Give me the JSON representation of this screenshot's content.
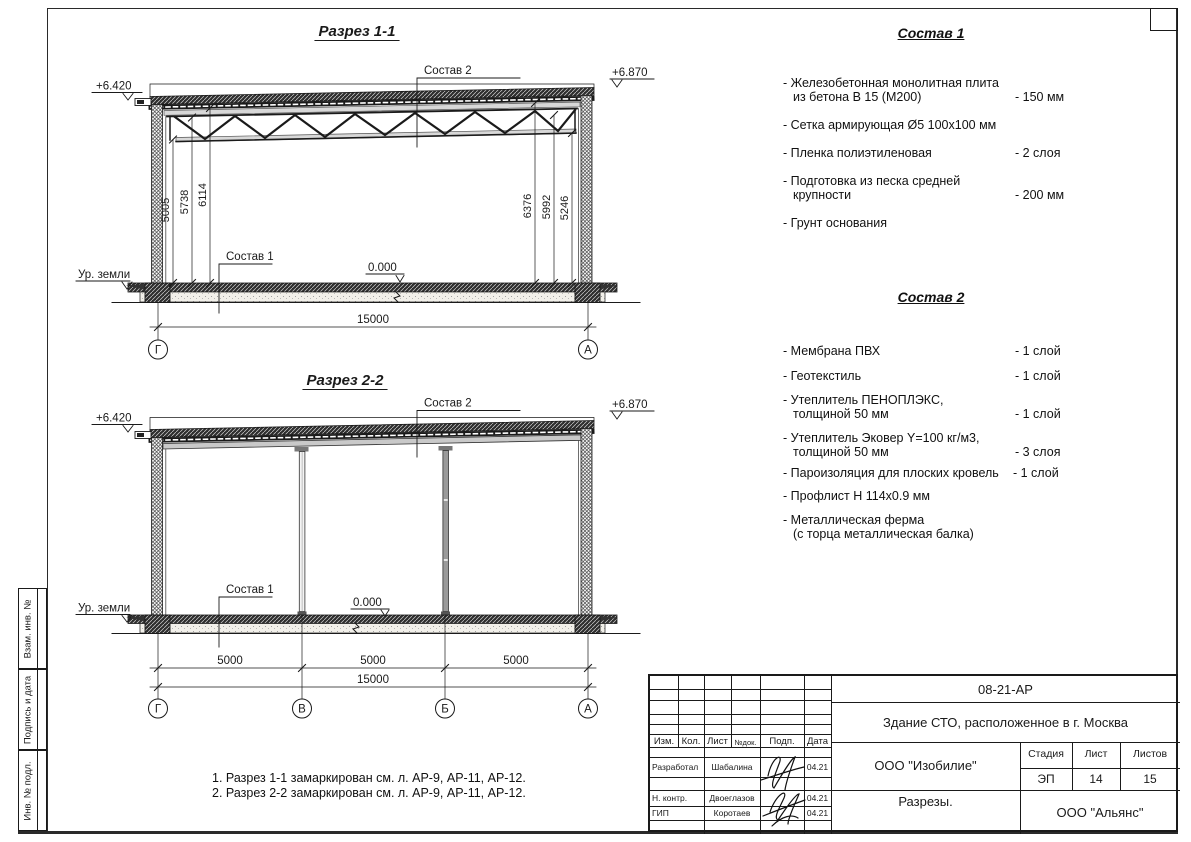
{
  "colors": {
    "ink": "#1a1a1a",
    "paper": "#ffffff"
  },
  "side_strip": {
    "cells": [
      {
        "label": "Взам. инв. №"
      },
      {
        "label": "Подпись и дата"
      },
      {
        "label": "Инв. № подл."
      }
    ]
  },
  "section1": {
    "title": "Разрез 1-1",
    "elev_left": "+6.420",
    "elev_right": "+6.870",
    "callout_roof": "Состав 2",
    "callout_floor": "Состав 1",
    "level_mark": "0.000",
    "ground_label": "Ур. земли",
    "vdims_left": [
      "5005",
      "5738",
      "6114"
    ],
    "vdims_right": [
      "6376",
      "5992",
      "5246"
    ],
    "total_dim": "15000",
    "axes": [
      "Г",
      "А"
    ]
  },
  "section2": {
    "title": "Разрез 2-2",
    "elev_left": "+6.420",
    "elev_right": "+6.870",
    "callout_roof": "Состав 2",
    "callout_floor": "Состав 1",
    "level_mark": "0.000",
    "ground_label": "Ур. земли",
    "span_dims": [
      "5000",
      "5000",
      "5000"
    ],
    "total_dim": "15000",
    "axes": [
      "Г",
      "В",
      "Б",
      "А"
    ]
  },
  "sostav1": {
    "title": "Состав 1",
    "items": [
      {
        "lines": [
          "- Железобетонная  монолитная плита",
          "из бетона В 15 (М200)"
        ],
        "value": "- 150 мм"
      },
      {
        "lines": [
          "- Сетка армирующая Ø5 100х100 мм",
          ""
        ],
        "value": ""
      },
      {
        "lines": [
          "- Пленка полиэтиленовая",
          ""
        ],
        "value": "-  2 слоя"
      },
      {
        "lines": [
          "- Подготовка из песка средней",
          "крупности"
        ],
        "value": "- 200 мм"
      },
      {
        "lines": [
          "- Грунт основания",
          ""
        ],
        "value": ""
      }
    ]
  },
  "sostav2": {
    "title": "Состав 2",
    "items": [
      {
        "lines": [
          "- Мембрана ПВХ",
          ""
        ],
        "value": "- 1 слой"
      },
      {
        "lines": [
          "- Геотекстиль",
          ""
        ],
        "value": "- 1 слой"
      },
      {
        "lines": [
          "- Утеплитель ПЕНОПЛЭКС,",
          "толщиной 50 мм"
        ],
        "value": "- 1 слой"
      },
      {
        "lines": [
          "- Утеплитель Эковер Y=100 кг/м3,",
          "толщиной 50 мм"
        ],
        "value": "- 3 слоя"
      },
      {
        "lines": [
          "- Пароизоляция для плоских кровель",
          ""
        ],
        "value": "- 1 слой"
      },
      {
        "lines": [
          "- Профлист Н 114х0.9 мм",
          ""
        ],
        "value": ""
      },
      {
        "lines": [
          "- Металлическая ферма",
          "(с торца металлическая балка)"
        ],
        "value": ""
      }
    ]
  },
  "notes": {
    "lines": [
      "1. Разрез 1-1 замаркирован см. л. АР-9, АР-11, АР-12.",
      "2. Разрез 2-2 замаркирован см. л. АР-9, АР-11, АР-12."
    ]
  },
  "titleblock": {
    "doc_number": "08-21-АР",
    "object": "Здание СТО, расположенное в г. Москва",
    "header_cols": [
      "Изм.",
      "Кол.",
      "Лист",
      "№док.",
      "Подп.",
      "Дата"
    ],
    "sig_rows": [
      {
        "role": "Разработал",
        "name": "Шабалина",
        "date": "04.21"
      },
      {
        "role": "Н. контр.",
        "name": "Двоеглазов",
        "date": "04.21"
      },
      {
        "role": "ГИП",
        "name": "Коротаев",
        "date": "04.21"
      }
    ],
    "org": "ООО \"Изобилие\"",
    "stage_label": "Стадия",
    "sheet_label": "Лист",
    "sheets_label": "Листов",
    "stage": "ЭП",
    "sheet_no": "14",
    "sheets_total": "15",
    "drawing_title": "Разрезы.",
    "company": "ООО \"Альянс\""
  }
}
